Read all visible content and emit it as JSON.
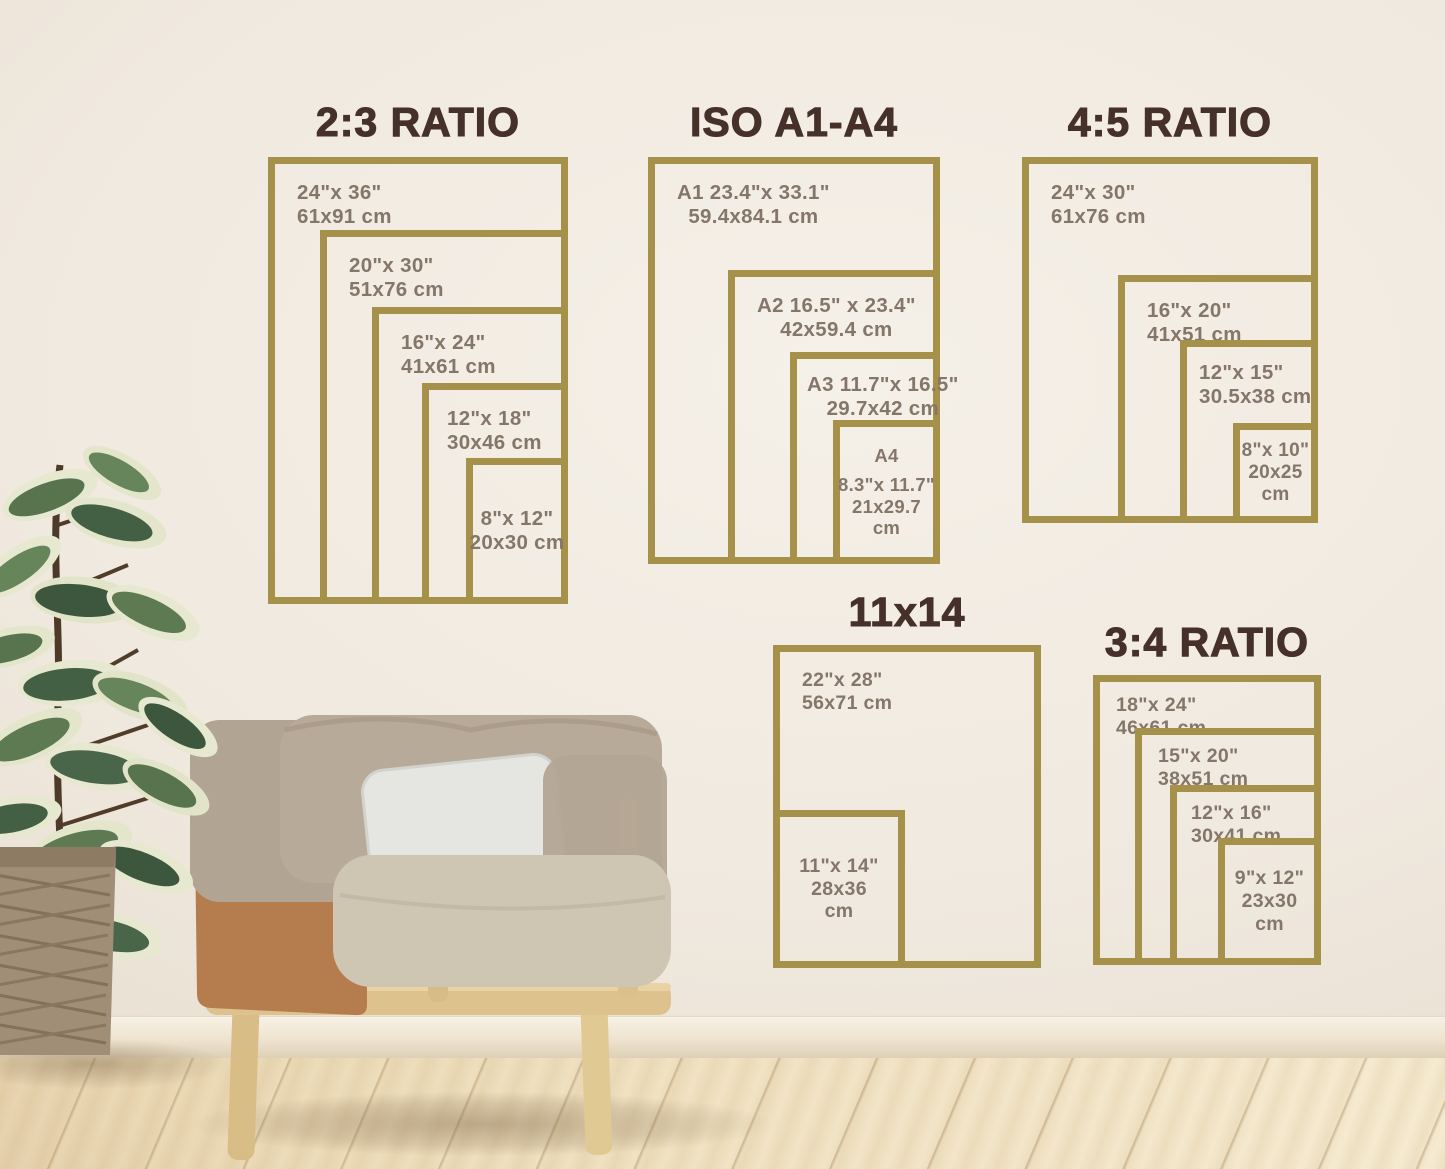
{
  "colors": {
    "frame_gold": "#a6914b",
    "title_brown": "#46302a",
    "label_brown": "#85766a",
    "wall": "#efe8de"
  },
  "charts": [
    {
      "title": "2:3 RATIO",
      "sizes": [
        {
          "l1": "24\"x 36\"",
          "l2": "61x91 cm"
        },
        {
          "l1": "20\"x 30\"",
          "l2": "51x76 cm"
        },
        {
          "l1": "16\"x 24\"",
          "l2": "41x61 cm"
        },
        {
          "l1": "12\"x 18\"",
          "l2": "30x46 cm"
        },
        {
          "l1": "8\"x 12\"",
          "l2": "20x30 cm"
        }
      ]
    },
    {
      "title": "ISO A1-A4",
      "sizes": [
        {
          "l1": "A1 23.4\"x 33.1\"",
          "l2": "59.4x84.1 cm"
        },
        {
          "l1": "A2 16.5\" x 23.4\"",
          "l2": "42x59.4 cm"
        },
        {
          "l1": "A3 11.7\"x 16.5\"",
          "l2": "29.7x42 cm"
        },
        {
          "l1": "A4",
          "l2": "8.3\"x 11.7\"",
          "l3": "21x29.7",
          "l4": "cm"
        }
      ]
    },
    {
      "title": "4:5 RATIO",
      "sizes": [
        {
          "l1": "24\"x 30\"",
          "l2": "61x76 cm"
        },
        {
          "l1": "16\"x 20\"",
          "l2": "41x51 cm"
        },
        {
          "l1": "12\"x 15\"",
          "l2": "30.5x38 cm"
        },
        {
          "l1": "8\"x 10\"",
          "l2": "20x25",
          "l3": "cm"
        }
      ]
    },
    {
      "title": "11x14",
      "sizes": [
        {
          "l1": "22\"x 28\"",
          "l2": "56x71 cm"
        },
        {
          "l1": "11\"x 14\"",
          "l2": "28x36",
          "l3": "cm"
        }
      ]
    },
    {
      "title": "3:4 RATIO",
      "sizes": [
        {
          "l1": "18\"x 24\"",
          "l2": "46x61 cm"
        },
        {
          "l1": "15\"x 20\"",
          "l2": "38x51 cm"
        },
        {
          "l1": "12\"x 16\"",
          "l2": "30x41 cm"
        },
        {
          "l1": "9\"x 12\"",
          "l2": "23x30",
          "l3": "cm"
        }
      ]
    }
  ]
}
